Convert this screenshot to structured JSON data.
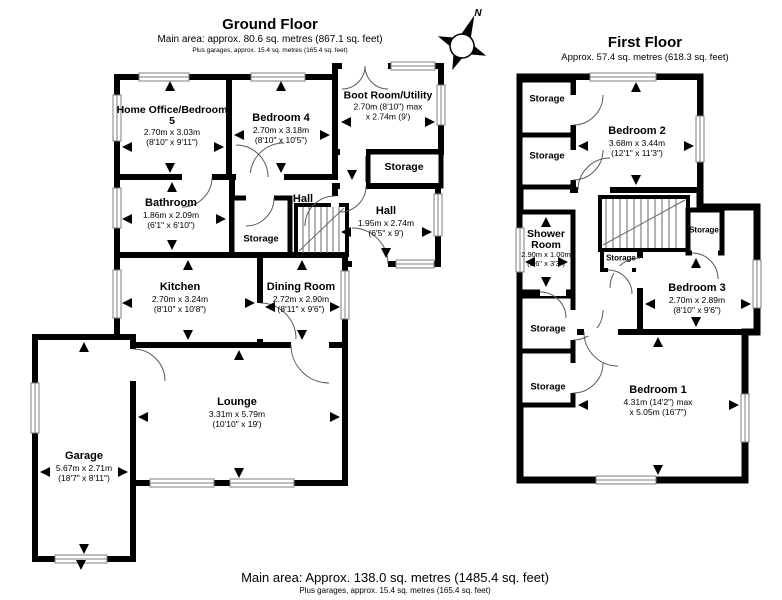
{
  "compass": {
    "north": "N"
  },
  "ground_floor": {
    "title": "Ground Floor",
    "subtitle": "Main area: approx. 80.6 sq. metres (867.1 sq. feet)",
    "note": "Plus garages, approx. 15.4 sq. metres (165.4 sq. feet)",
    "rooms": {
      "home_office": {
        "name": "Home Office/Bedroom 5",
        "metric": "2.70m x 3.03m",
        "imperial": "(8'10\" x 9'11\")"
      },
      "bedroom4": {
        "name": "Bedroom 4",
        "metric": "2.70m x 3.18m",
        "imperial": "(8'10\" x 10'5\")"
      },
      "boot_room": {
        "name": "Boot Room/Utility",
        "metric": "2.70m (8'10\") max",
        "imperial": "x 2.74m (9')"
      },
      "storage_boot": {
        "name": "Storage"
      },
      "bathroom": {
        "name": "Bathroom",
        "metric": "1.86m x 2.09m",
        "imperial": "(6'1\" x 6'10\")"
      },
      "storage_hall": {
        "name": "Storage"
      },
      "hall_left": {
        "name": "Hall"
      },
      "hall": {
        "name": "Hall",
        "metric": "1.95m x 2.74m",
        "imperial": "(6'5\" x 9')"
      },
      "kitchen": {
        "name": "Kitchen",
        "metric": "2.70m x 3.24m",
        "imperial": "(8'10\" x 10'8\")"
      },
      "dining": {
        "name": "Dining Room",
        "metric": "2.72m x 2.90m",
        "imperial": "(8'11\" x 9'6\")"
      },
      "lounge": {
        "name": "Lounge",
        "metric": "3.31m x 5.79m",
        "imperial": "(10'10\" x 19')"
      },
      "garage": {
        "name": "Garage",
        "metric": "5.67m x 2.71m",
        "imperial": "(18'7\" x 8'11\")"
      }
    }
  },
  "first_floor": {
    "title": "First Floor",
    "subtitle": "Approx. 57.4 sq. metres (618.3 sq. feet)",
    "rooms": {
      "bedroom2": {
        "name": "Bedroom 2",
        "metric": "3.68m x 3.44m",
        "imperial": "(12'1\" x 11'3\")"
      },
      "shower": {
        "name": "Shower Room",
        "metric": "2.90m x 1.00m",
        "imperial": "(9'6\" x 3'3\")"
      },
      "bedroom3": {
        "name": "Bedroom 3",
        "metric": "2.70m x 2.89m",
        "imperial": "(8'10\" x 9'6\")"
      },
      "bedroom1": {
        "name": "Bedroom 1",
        "metric": "4.31m (14'2\") max",
        "imperial": "x 5.05m (16'7\")"
      },
      "storage1": {
        "name": "Storage"
      },
      "storage2": {
        "name": "Storage"
      },
      "storage3": {
        "name": "Storage"
      },
      "storage4": {
        "name": "Storage"
      },
      "storage_stairs": {
        "name": "Storage"
      },
      "storage_under": {
        "name": "Storage"
      }
    }
  },
  "footer": {
    "main": "Main area: Approx. 138.0 sq. metres (1485.4 sq. feet)",
    "note": "Plus garages, approx. 15.4 sq. metres (165.4 sq. feet)"
  }
}
